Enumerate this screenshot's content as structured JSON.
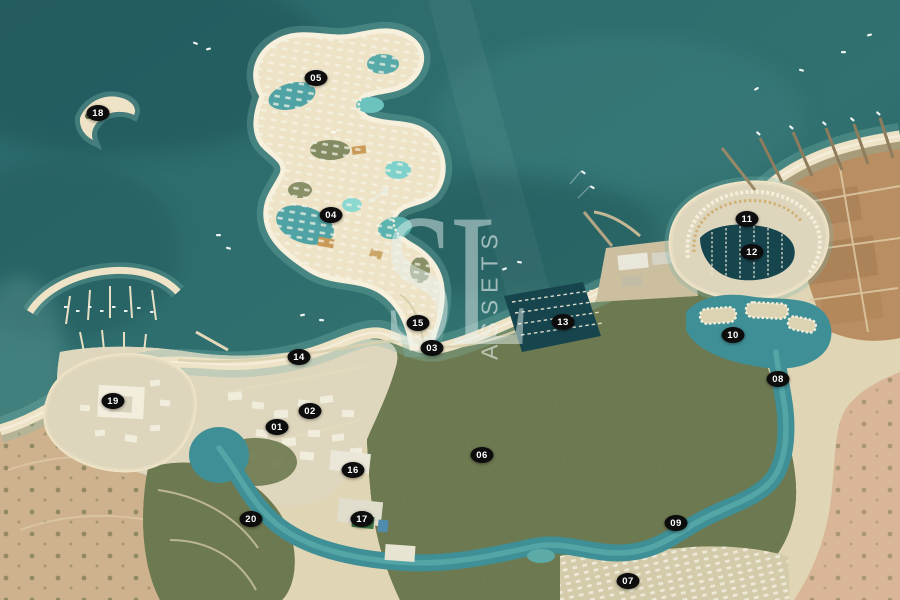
{
  "watermark": {
    "letters": "SL",
    "vertical_text": "ASSETS",
    "arrow_icon": "paper-plane-arrow"
  },
  "markers": [
    {
      "label": "01",
      "x": 277,
      "y": 427
    },
    {
      "label": "02",
      "x": 310,
      "y": 411
    },
    {
      "label": "03",
      "x": 432,
      "y": 348
    },
    {
      "label": "04",
      "x": 331,
      "y": 215
    },
    {
      "label": "05",
      "x": 316,
      "y": 78
    },
    {
      "label": "06",
      "x": 482,
      "y": 455
    },
    {
      "label": "07",
      "x": 628,
      "y": 581
    },
    {
      "label": "08",
      "x": 778,
      "y": 379
    },
    {
      "label": "09",
      "x": 676,
      "y": 523
    },
    {
      "label": "10",
      "x": 733,
      "y": 335
    },
    {
      "label": "11",
      "x": 747,
      "y": 219
    },
    {
      "label": "12",
      "x": 752,
      "y": 252
    },
    {
      "label": "13",
      "x": 563,
      "y": 322
    },
    {
      "label": "14",
      "x": 299,
      "y": 357
    },
    {
      "label": "15",
      "x": 418,
      "y": 323
    },
    {
      "label": "16",
      "x": 353,
      "y": 470
    },
    {
      "label": "17",
      "x": 362,
      "y": 519
    },
    {
      "label": "18",
      "x": 98,
      "y": 113
    },
    {
      "label": "19",
      "x": 113,
      "y": 401
    },
    {
      "label": "20",
      "x": 251,
      "y": 519
    }
  ],
  "palette": {
    "sea_mid": "#2d6b6e",
    "sea_deep": "#1d4f53",
    "sea_light": "#3b7d7d",
    "shallow": "#7db8af",
    "beach": "#eee3c6",
    "sand": "#e0d5b4",
    "urban": "#ddd6bd",
    "green": "#6d7950",
    "green_dark": "#4c5c35",
    "desert": "#b98e62",
    "desert_pink": "#d9b697",
    "desert_sand": "#cdb28d",
    "canal": "#3f8f96",
    "water_dark": "#17454e",
    "building": "#f3efdf",
    "marker_bg": "#0d0d0d",
    "marker_text": "#ffffff",
    "watermark": "#e9f3f1"
  }
}
